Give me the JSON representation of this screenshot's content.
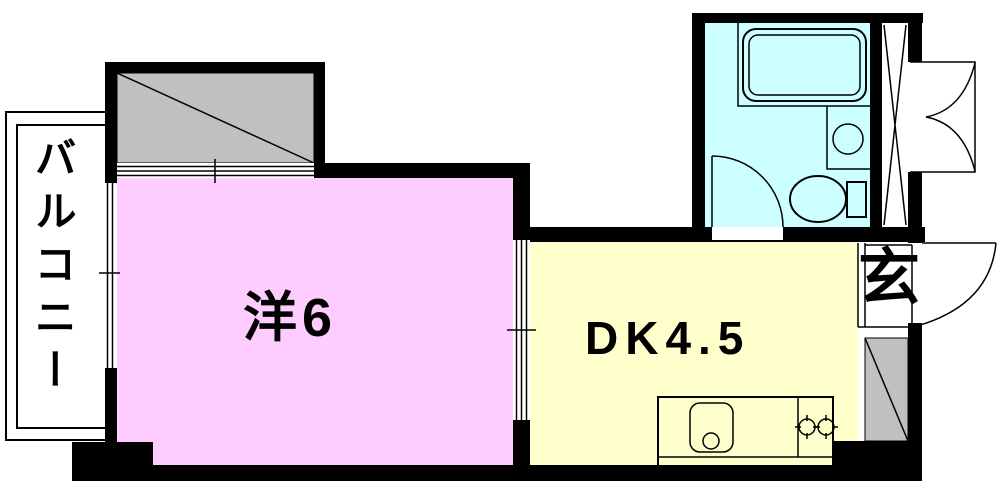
{
  "title": "1DK apartment floor plan",
  "rooms": {
    "balcony": {
      "label": "バルコニー"
    },
    "western": {
      "label": "洋6",
      "tatami": 6,
      "fill": "#FFCCFF"
    },
    "dk": {
      "label": "DK4.5",
      "tatami": 4.5,
      "fill": "#FFFFCC"
    },
    "bathroom": {
      "fill": "#CCFFFF"
    },
    "entrance": {
      "label": "玄"
    }
  },
  "colors": {
    "wall": "#000000",
    "hatch": "#C0C0C0",
    "line": "#000000",
    "background": "#FFFFFF"
  },
  "icons": [
    "bathtub-icon",
    "washbasin-icon",
    "toilet-icon",
    "kitchen-sink-icon",
    "gas-stove-icon",
    "bathroom-door-swing-icon",
    "entrance-door-swing-icon",
    "double-door-icon",
    "pipe-shaft-x-icon",
    "window-icon",
    "sliding-partition-icon",
    "hatched-void-icon"
  ]
}
